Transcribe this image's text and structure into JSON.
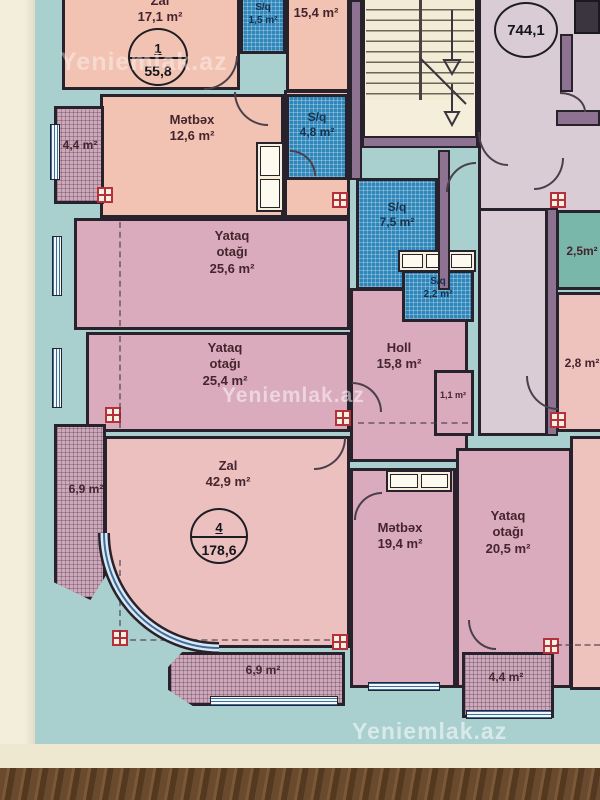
{
  "watermark": "Yeniemlak.az",
  "badges": {
    "building_total": "744,1",
    "apt1": {
      "number": "1",
      "total": "55,8"
    },
    "apt4": {
      "number": "4",
      "total": "178,6"
    }
  },
  "colors": {
    "paper_teal": "#a9cfcf",
    "paper_cream": "#efe8d4",
    "wood": "#6a4a2e",
    "wall_dark": "#27222b",
    "wall_purple": "#8d7292",
    "room_pink": "#f2c3b2",
    "room_mauve": "#d9abbc",
    "room_rose": "#ecc0bf",
    "wet_blue": "#2f86ba",
    "corridor_lavender": "#d9ccd4",
    "stairs_cream": "#f4eedb",
    "room_teal": "#79b7ab",
    "room_lightpink": "#eec2bd",
    "balcony_hatch": "#cfa9ba",
    "column_red": "#b5303c"
  },
  "rooms": {
    "zal1": {
      "name": "Zal",
      "area": "17,1 m²"
    },
    "sq15": {
      "name": "S/q",
      "area": "1,5 m²"
    },
    "r154": {
      "area": "15,4 m²"
    },
    "metbex1": {
      "name": "Mətbəx",
      "area": "12,6 m²"
    },
    "balc44L": {
      "area": "4,4 m²"
    },
    "sq48": {
      "name": "S/q",
      "area": "4,8 m²"
    },
    "sq75": {
      "name": "S/q",
      "area": "7,5 m²"
    },
    "sq22": {
      "name": "S/q",
      "area": "2,2 m²"
    },
    "r25": {
      "area": "2,5m²"
    },
    "r28": {
      "area": "2,8 m²"
    },
    "yataq256": {
      "name": "Yataq",
      "name2": "otağı",
      "area": "25,6 m²"
    },
    "yataq254": {
      "name": "Yataq",
      "name2": "otağı",
      "area": "25,4 m²"
    },
    "holl": {
      "name": "Holl",
      "area": "15,8 m²"
    },
    "r11": {
      "area": "1,1 m²"
    },
    "zal4": {
      "name": "Zal",
      "area": "42,9 m²"
    },
    "metbex4": {
      "name": "Mətbəx",
      "area": "19,4 m²"
    },
    "yataq205": {
      "name": "Yataq",
      "name2": "otağı",
      "area": "20,5 m²"
    },
    "balc69L": {
      "area": "6,9 m²"
    },
    "balc69B": {
      "area": "6,9 m²"
    },
    "balc44B": {
      "area": "4,4 m²"
    }
  }
}
